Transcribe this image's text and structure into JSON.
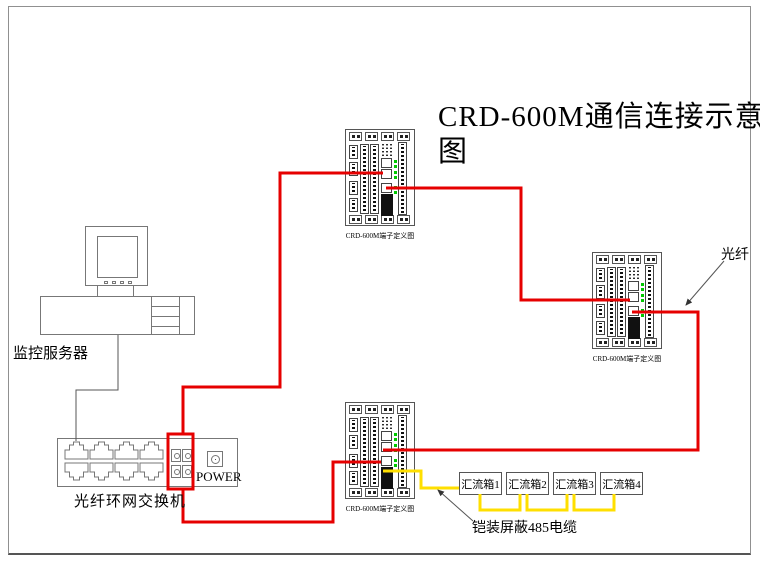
{
  "title": {
    "line1": "CRD-600M通信连接示意",
    "line2": "图"
  },
  "labels": {
    "server": "监控服务器",
    "switch": "光纤环网交换机",
    "power": "POWER",
    "fiber": "光纤",
    "cable": "铠装屏蔽485电缆",
    "panel_caption": "CRD-600M端子定义图"
  },
  "combiner_boxes": [
    {
      "label": "汇流箱1"
    },
    {
      "label": "汇流箱2"
    },
    {
      "label": "汇流箱3"
    },
    {
      "label": "汇流箱4"
    }
  ],
  "colors": {
    "fiber_wire": "#e60000",
    "cable_wire": "#ffdf00",
    "led": "#00c800",
    "line": "#555555"
  },
  "diagram": {
    "panels": [
      {
        "left": 345,
        "top": 129
      },
      {
        "left": 592,
        "top": 252
      },
      {
        "left": 345,
        "top": 402
      }
    ],
    "combiner_layout": {
      "left": 459,
      "top": 472,
      "width": 43,
      "height": 23,
      "gap": 47
    },
    "wires": [
      {
        "name": "fiber-switch-to-top-panel",
        "color": "fiber_wire",
        "width": 3,
        "points": [
          [
            183,
            433
          ],
          [
            183,
            387
          ],
          [
            280,
            387
          ],
          [
            280,
            173
          ],
          [
            383,
            173
          ]
        ]
      },
      {
        "name": "fiber-top-panel-to-right-panel",
        "color": "fiber_wire",
        "width": 3,
        "points": [
          [
            386,
            188
          ],
          [
            521,
            188
          ],
          [
            521,
            300
          ],
          [
            630,
            300
          ]
        ]
      },
      {
        "name": "fiber-right-panel-to-bottom-panel",
        "color": "fiber_wire",
        "width": 3,
        "points": [
          [
            632,
            312
          ],
          [
            698,
            312
          ],
          [
            698,
            450
          ],
          [
            383,
            450
          ]
        ]
      },
      {
        "name": "fiber-bottom-panel-to-switch",
        "color": "fiber_wire",
        "width": 3,
        "points": [
          [
            381,
            462
          ],
          [
            333,
            462
          ],
          [
            333,
            522
          ],
          [
            183,
            522
          ],
          [
            183,
            489
          ]
        ]
      },
      {
        "name": "rs485-panel-to-box1",
        "color": "cable_wire",
        "width": 3,
        "points": [
          [
            383,
            471
          ],
          [
            421,
            471
          ],
          [
            421,
            488
          ],
          [
            459,
            488
          ]
        ]
      },
      {
        "name": "rs485-box1-to-box2",
        "color": "cable_wire",
        "width": 3,
        "points": [
          [
            480,
            494
          ],
          [
            480,
            510
          ],
          [
            520,
            510
          ],
          [
            520,
            494
          ]
        ]
      },
      {
        "name": "rs485-box2-to-box3",
        "color": "cable_wire",
        "width": 3,
        "points": [
          [
            527,
            494
          ],
          [
            527,
            510
          ],
          [
            567,
            510
          ],
          [
            567,
            494
          ]
        ]
      },
      {
        "name": "rs485-box3-to-box4",
        "color": "cable_wire",
        "width": 3,
        "points": [
          [
            574,
            494
          ],
          [
            574,
            510
          ],
          [
            614,
            510
          ],
          [
            614,
            494
          ]
        ]
      },
      {
        "name": "ethernet-server-to-switch",
        "color": "line",
        "width": 1,
        "points": [
          [
            118,
            335
          ],
          [
            118,
            390
          ],
          [
            76,
            390
          ],
          [
            76,
            441
          ]
        ]
      },
      {
        "name": "fiber-leader",
        "color": "line",
        "width": 1,
        "arrow": true,
        "points": [
          [
            724,
            261
          ],
          [
            686,
            305
          ]
        ]
      },
      {
        "name": "cable-leader",
        "color": "line",
        "width": 1,
        "arrow": true,
        "points": [
          [
            473,
            521
          ],
          [
            438,
            490
          ]
        ]
      }
    ],
    "connector_rect": {
      "x": 168,
      "y": 434,
      "width": 25,
      "height": 55,
      "color": "fiber_wire",
      "stroke": 3
    }
  }
}
